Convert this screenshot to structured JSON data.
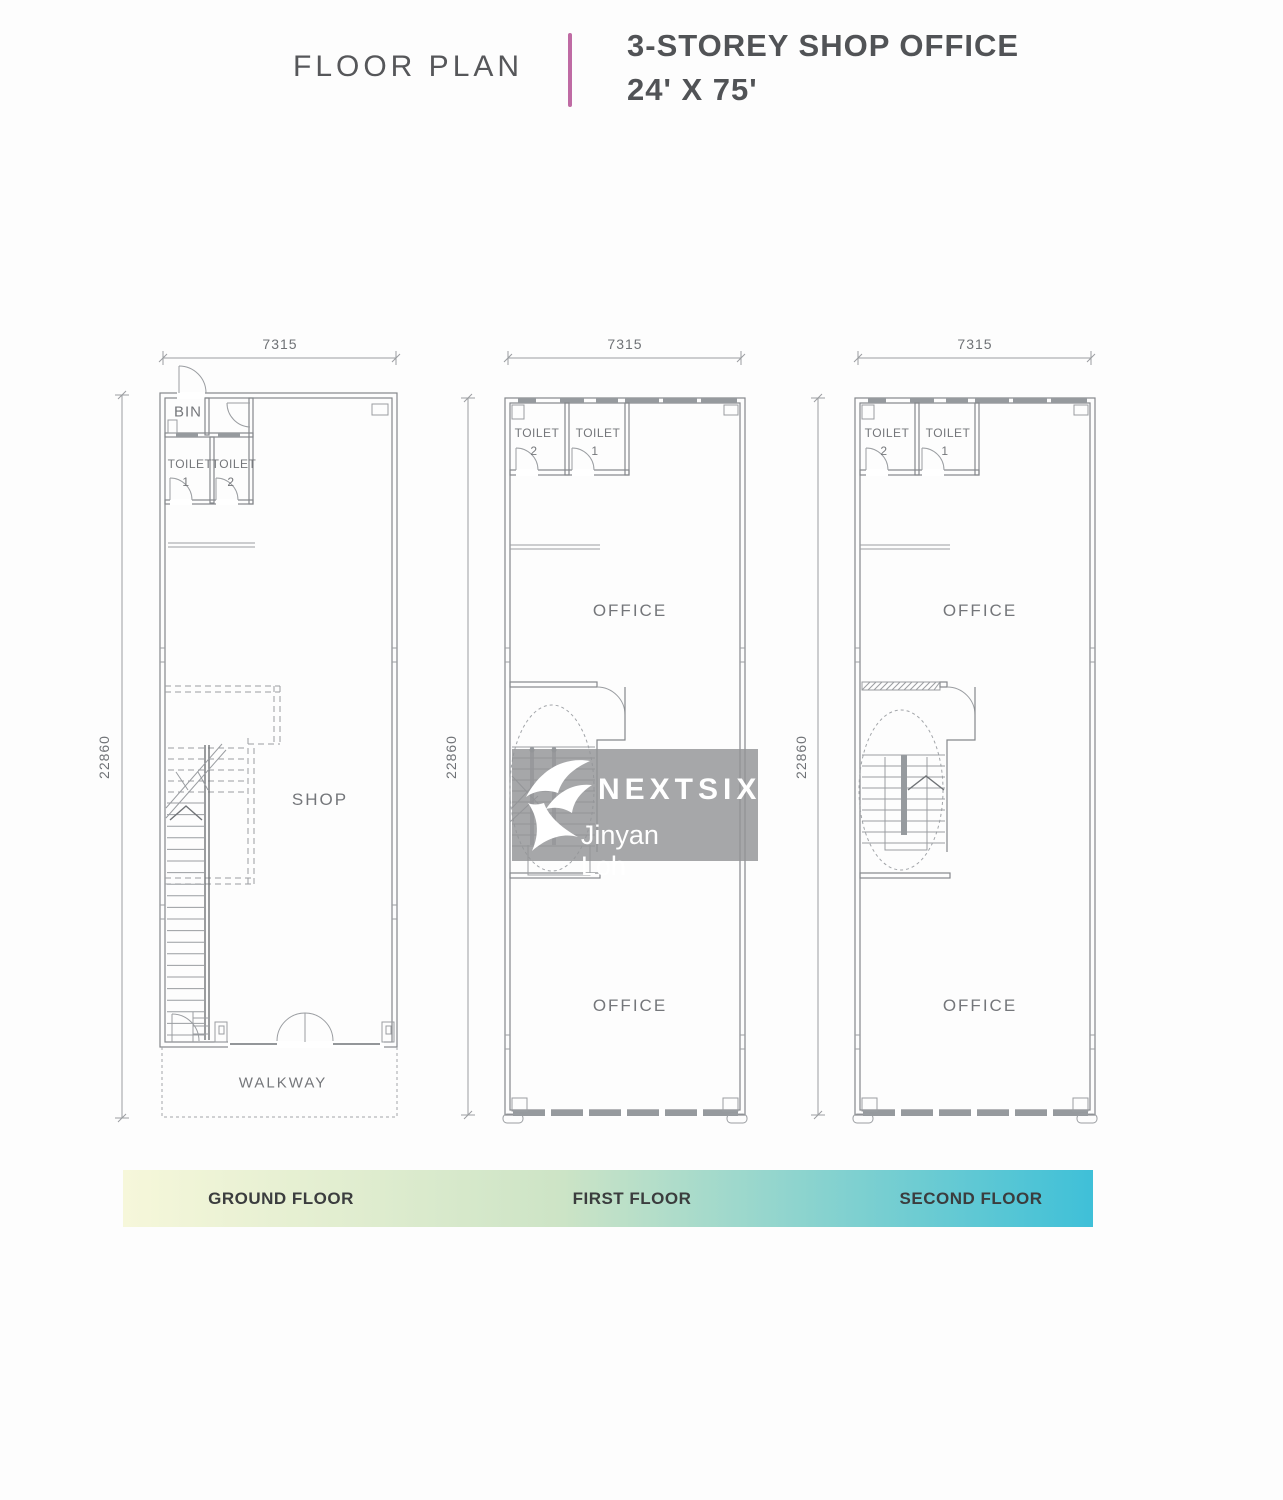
{
  "header": {
    "title": "FLOOR PLAN",
    "subtitle_line1": "3-STOREY SHOP OFFICE",
    "subtitle_line2": "24' X 75'"
  },
  "accent_color": "#bf6ba4",
  "watermark": {
    "brand": "NEXTSIX",
    "agent": "Jinyan Loh"
  },
  "floors": {
    "ground": {
      "name": "GROUND FLOOR",
      "dim_width": "7315",
      "dim_depth": "22860",
      "rooms": {
        "bin": "BIN",
        "toilet_left": "TOILET",
        "toilet_left_num": "1",
        "toilet_right": "TOILET",
        "toilet_right_num": "2",
        "main": "SHOP",
        "walkway": "WALKWAY"
      }
    },
    "first": {
      "name": "FIRST FLOOR",
      "dim_width": "7315",
      "dim_depth": "22860",
      "rooms": {
        "toilet_left": "TOILET",
        "toilet_left_num": "2",
        "toilet_right": "TOILET",
        "toilet_right_num": "1",
        "office_upper": "OFFICE",
        "office_lower": "OFFICE"
      }
    },
    "second": {
      "name": "SECOND FLOOR",
      "dim_width": "7315",
      "dim_depth": "22860",
      "rooms": {
        "toilet_left": "TOILET",
        "toilet_left_num": "2",
        "toilet_right": "TOILET",
        "toilet_right_num": "1",
        "office_upper": "OFFICE",
        "office_lower": "OFFICE"
      }
    }
  },
  "legend": {
    "labels": [
      "GROUND FLOOR",
      "FIRST FLOOR",
      "SECOND FLOOR"
    ],
    "gradient": {
      "start": "#f6f7da",
      "mid": "#cde4c6",
      "end": "#3fc0d8"
    }
  }
}
